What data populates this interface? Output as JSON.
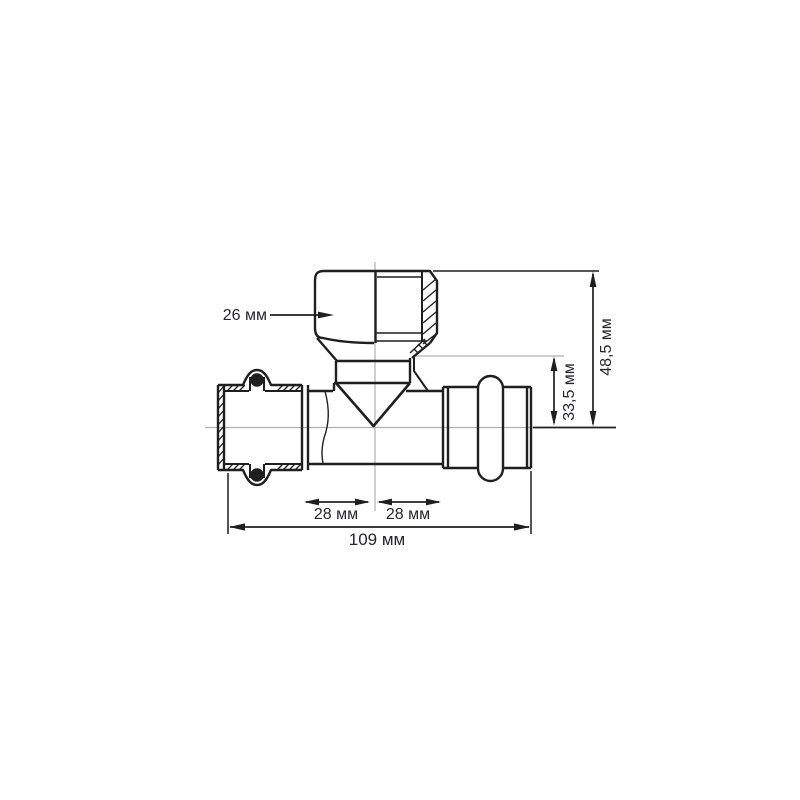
{
  "drawing": {
    "colors": {
      "line": "#1f1f1f",
      "centerline": "#b0b0b0",
      "text": "#26262b",
      "background": "#ffffff"
    },
    "dimensions": {
      "branch_bore": {
        "label": "26 мм"
      },
      "overall_height": {
        "label": "48,5 мм"
      },
      "branch_to_center": {
        "label": "33,5 мм"
      },
      "left_of_center": {
        "label": "28 мм"
      },
      "right_of_center": {
        "label": "28 мм"
      },
      "overall_length": {
        "label": "109 мм"
      }
    }
  }
}
